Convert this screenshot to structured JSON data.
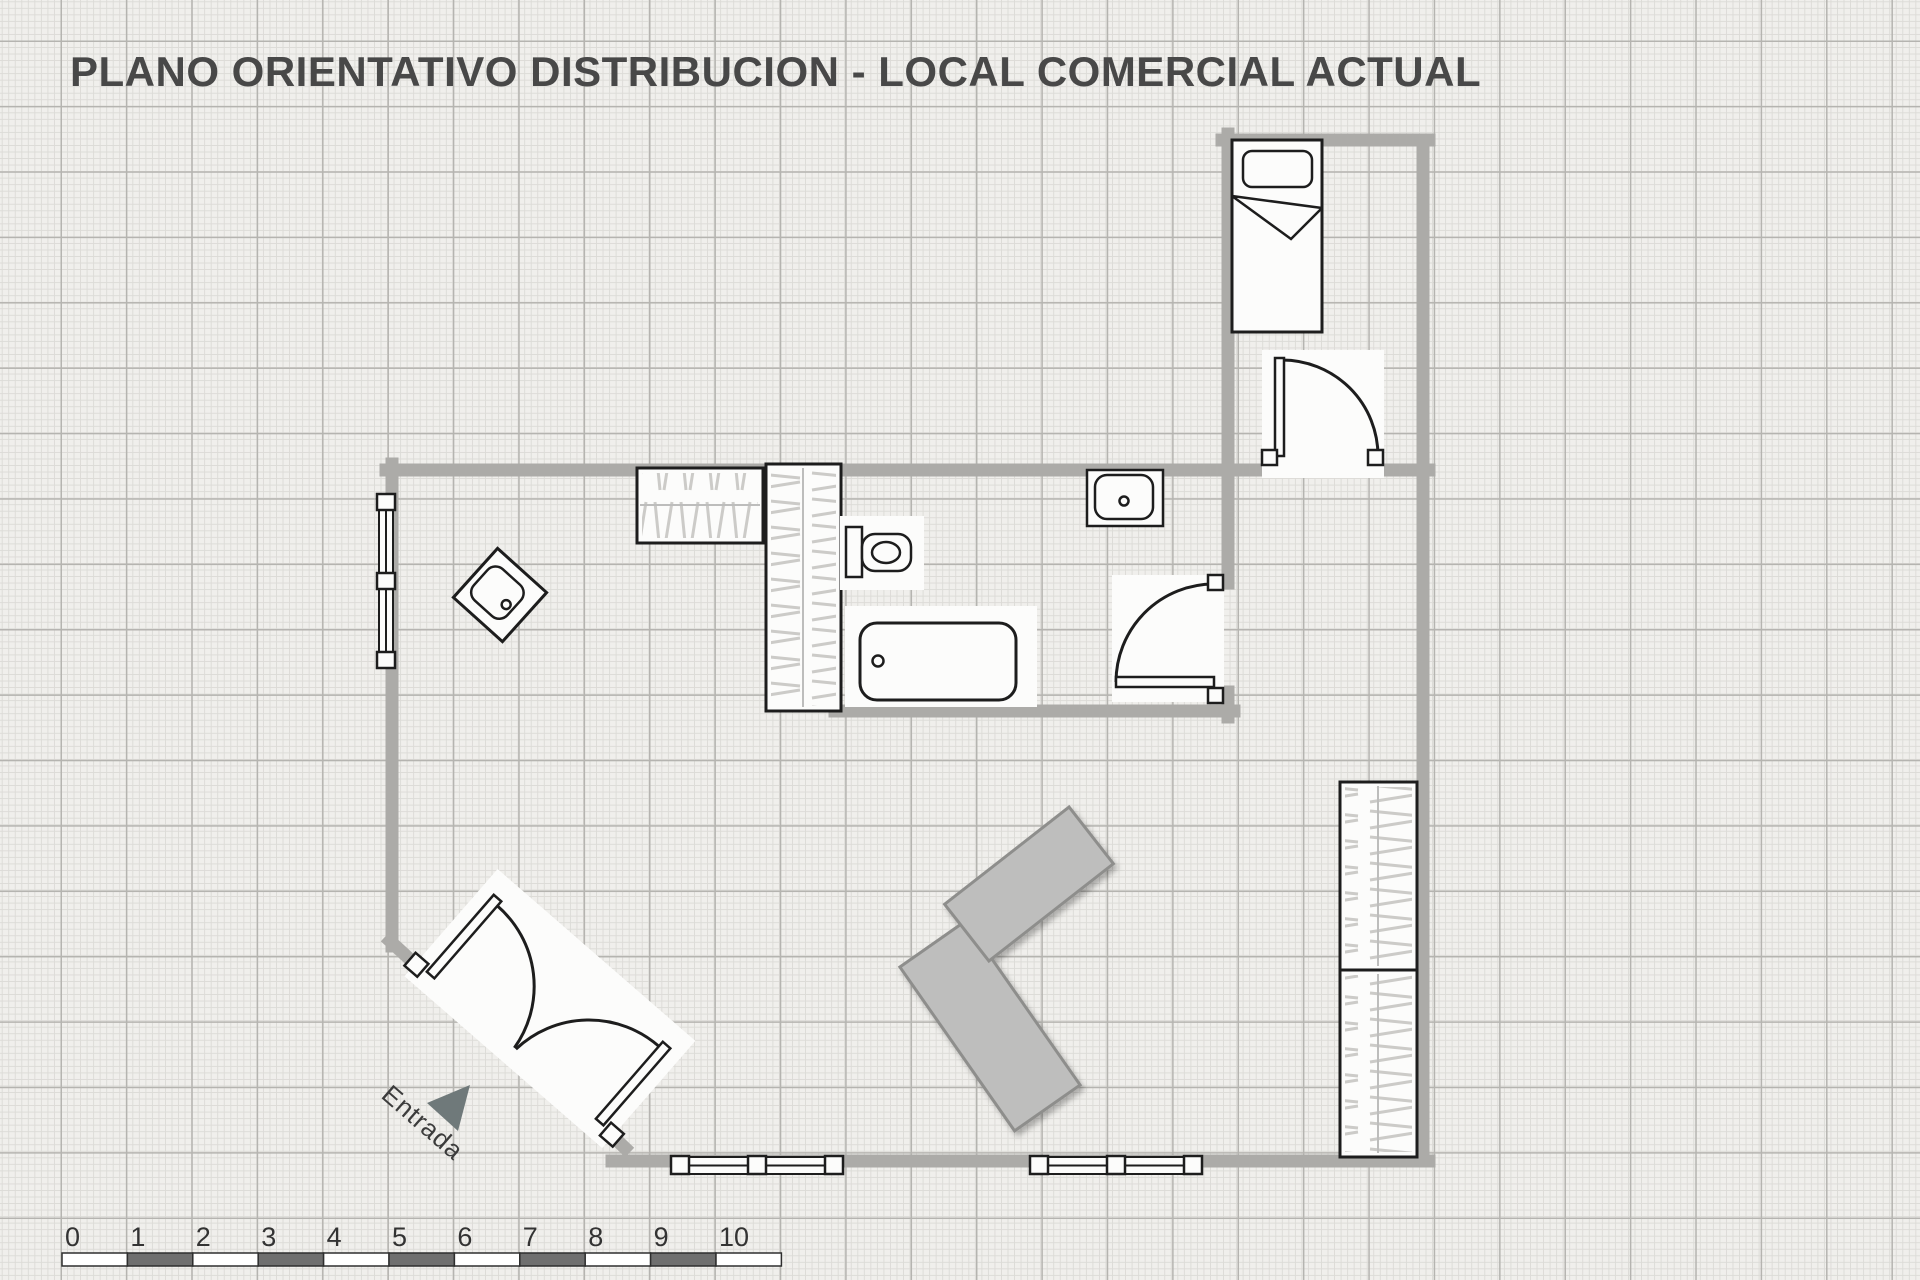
{
  "title": "PLANO ORIENTATIVO DISTRIBUCION - LOCAL COMERCIAL ACTUAL",
  "entrance": {
    "label": "Entrada"
  },
  "scale_ruler": {
    "labels": [
      "0",
      "1",
      "2",
      "3",
      "4",
      "5",
      "6",
      "7",
      "8",
      "9",
      "10"
    ]
  },
  "symbols": [
    "bed",
    "bedroom-door",
    "bathroom-door",
    "entrance-double-door",
    "wardrobe-horizontal",
    "wardrobe-tall",
    "shelving-right-top",
    "shelving-right-bottom",
    "toilet",
    "bathtub",
    "bathroom-sink",
    "kitchen-sink-diamond",
    "window-left",
    "window-bottom-left",
    "window-bottom-right",
    "counter-upper",
    "counter-lower",
    "entrance-arrow"
  ],
  "colors": {
    "paper": "#f0efec",
    "grid_minor": "#dcdbd7",
    "grid_major": "#b5b4b0",
    "wall": "#acaba8",
    "outline": "#1d1d1d",
    "counter_fill": "#bebebd",
    "counter_border": "#8e8e8c",
    "ruler_dark": "#6f6f6f",
    "triangle": "#6f797a",
    "title_text": "#484848",
    "label_text": "#3c3c3c"
  }
}
